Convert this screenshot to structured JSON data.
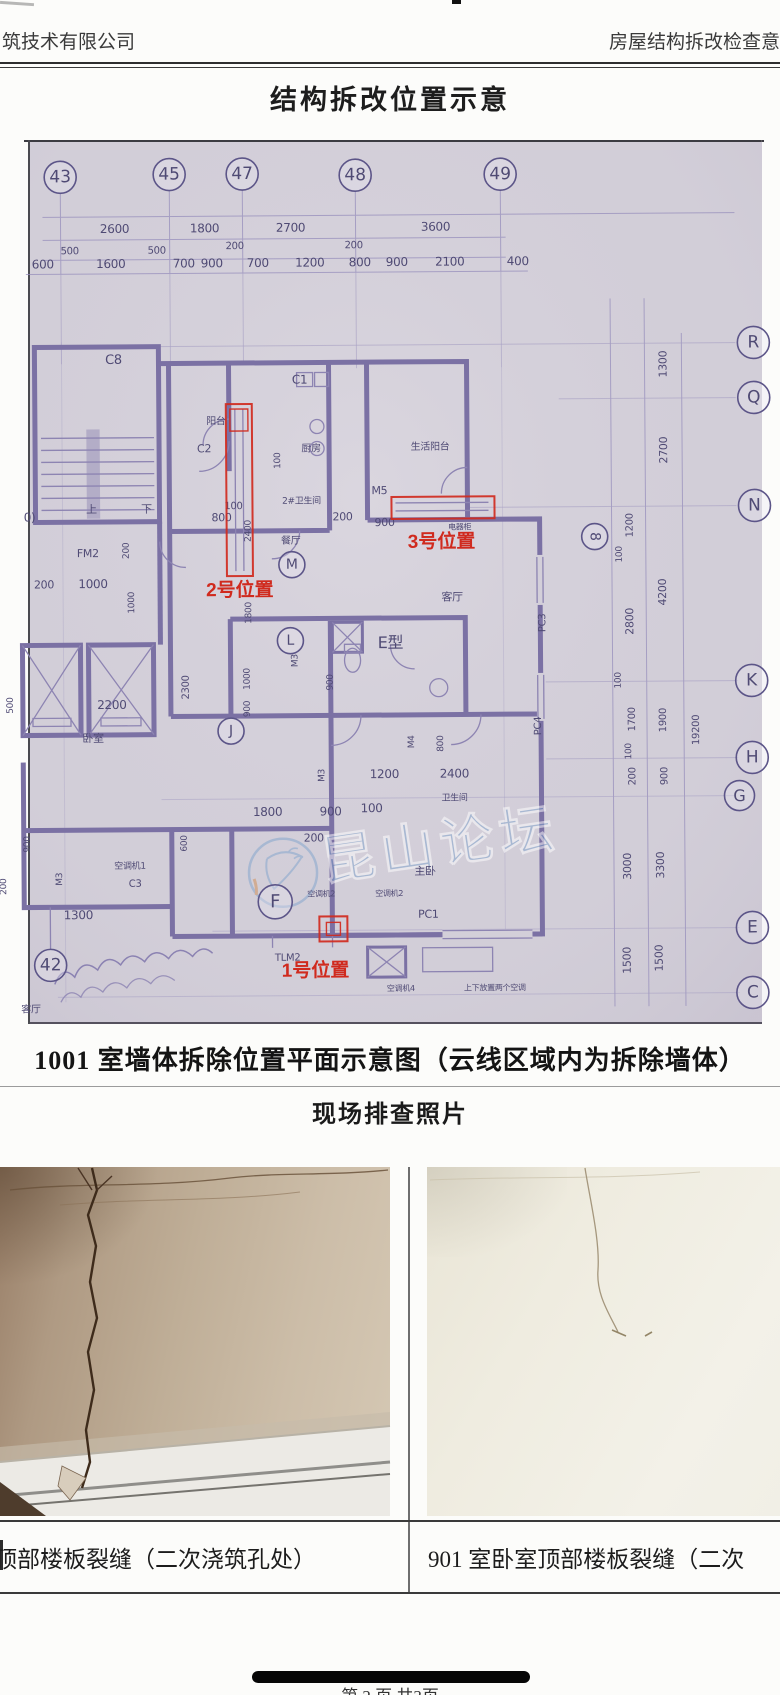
{
  "header": {
    "left": "筑技术有限公司",
    "right": "房屋结构拆改检查意"
  },
  "title": "结构拆改位置示意",
  "plan": {
    "caption": "1001 室墙体拆除位置平面示意图（云线区域内为拆除墙体）",
    "unit_type_label": "E型",
    "watermark": {
      "text": "昆山论坛",
      "color": "#7ea2cc"
    },
    "colors": {
      "red": "#d02a1e",
      "ink": "#4f4a74",
      "bubble": "#5c5588"
    },
    "bubbles": [
      {
        "x": 63,
        "y": 175,
        "t": "43",
        "r": 16
      },
      {
        "x": 172,
        "y": 173,
        "t": "45",
        "r": 16
      },
      {
        "x": 245,
        "y": 173,
        "t": "47",
        "r": 16
      },
      {
        "x": 358,
        "y": 175,
        "t": "48",
        "r": 16
      },
      {
        "x": 503,
        "y": 175,
        "t": "49",
        "r": 16
      },
      {
        "x": 755,
        "y": 345,
        "t": "R",
        "r": 16
      },
      {
        "x": 755,
        "y": 400,
        "t": "Q",
        "r": 16
      },
      {
        "x": 755,
        "y": 508,
        "t": "N",
        "r": 16
      },
      {
        "x": 751,
        "y": 683,
        "t": "K",
        "r": 16
      },
      {
        "x": 751,
        "y": 760,
        "t": "H",
        "r": 16
      },
      {
        "x": 738,
        "y": 798,
        "t": "G",
        "r": 15
      },
      {
        "x": 750,
        "y": 930,
        "t": "E",
        "r": 16
      },
      {
        "x": 750,
        "y": 995,
        "t": "C",
        "r": 16
      },
      {
        "x": 292,
        "y": 564,
        "t": "M",
        "r": 13
      },
      {
        "x": 290,
        "y": 640,
        "t": "L",
        "r": 13
      },
      {
        "x": 230,
        "y": 730,
        "t": "J",
        "r": 13
      },
      {
        "x": 273,
        "y": 901,
        "t": "F",
        "r": 17
      },
      {
        "x": 595,
        "y": 538,
        "t": "8",
        "r": 13,
        "rot": 90
      },
      {
        "x": 48,
        "y": 963,
        "t": "42",
        "r": 16
      }
    ],
    "labels": [
      {
        "x": 117,
        "y": 231,
        "t": "2600",
        "s": 12
      },
      {
        "x": 207,
        "y": 231,
        "t": "1800",
        "s": 12
      },
      {
        "x": 293,
        "y": 231,
        "t": "2700",
        "s": 12
      },
      {
        "x": 438,
        "y": 231,
        "t": "3600",
        "s": 12
      },
      {
        "x": 72,
        "y": 252,
        "t": "500",
        "s": 10
      },
      {
        "x": 159,
        "y": 252,
        "t": "500",
        "s": 10
      },
      {
        "x": 237,
        "y": 248,
        "t": "200",
        "s": 10
      },
      {
        "x": 356,
        "y": 248,
        "t": "200",
        "s": 10
      },
      {
        "x": 45,
        "y": 266,
        "t": "600",
        "s": 12
      },
      {
        "x": 113,
        "y": 266,
        "t": "1600",
        "s": 12
      },
      {
        "x": 186,
        "y": 266,
        "t": "700",
        "s": 12
      },
      {
        "x": 214,
        "y": 266,
        "t": "900",
        "s": 12
      },
      {
        "x": 260,
        "y": 266,
        "t": "700",
        "s": 12
      },
      {
        "x": 312,
        "y": 266,
        "t": "1200",
        "s": 12
      },
      {
        "x": 362,
        "y": 266,
        "t": "800",
        "s": 12
      },
      {
        "x": 399,
        "y": 266,
        "t": "900",
        "s": 12
      },
      {
        "x": 452,
        "y": 266,
        "t": "2100",
        "s": 12
      },
      {
        "x": 520,
        "y": 266,
        "t": "400",
        "s": 12
      },
      {
        "x": 668,
        "y": 366,
        "t": "1300",
        "rot": -90,
        "s": 11
      },
      {
        "x": 668,
        "y": 452,
        "t": "2700",
        "rot": -90,
        "s": 11
      },
      {
        "x": 633,
        "y": 527,
        "t": "1200",
        "rot": -90,
        "s": 10
      },
      {
        "x": 622,
        "y": 556,
        "t": "100",
        "rot": -90,
        "s": 9
      },
      {
        "x": 666,
        "y": 594,
        "t": "4200",
        "rot": -90,
        "s": 11
      },
      {
        "x": 633,
        "y": 623,
        "t": "2800",
        "rot": -90,
        "s": 11
      },
      {
        "x": 620,
        "y": 682,
        "t": "100",
        "rot": -90,
        "s": 9
      },
      {
        "x": 634,
        "y": 721,
        "t": "1700",
        "rot": -90,
        "s": 10
      },
      {
        "x": 665,
        "y": 722,
        "t": "1900",
        "rot": -90,
        "s": 10
      },
      {
        "x": 698,
        "y": 732,
        "t": "19200",
        "rot": -90,
        "s": 10
      },
      {
        "x": 630,
        "y": 753,
        "t": "100",
        "rot": -90,
        "s": 9
      },
      {
        "x": 634,
        "y": 778,
        "t": "200",
        "rot": -90,
        "s": 10
      },
      {
        "x": 666,
        "y": 778,
        "t": "900",
        "rot": -90,
        "s": 10
      },
      {
        "x": 629,
        "y": 868,
        "t": "3000",
        "rot": -90,
        "s": 11
      },
      {
        "x": 662,
        "y": 867,
        "t": "3300",
        "rot": -90,
        "s": 11
      },
      {
        "x": 628,
        "y": 962,
        "t": "1500",
        "rot": -90,
        "s": 11
      },
      {
        "x": 660,
        "y": 960,
        "t": "1500",
        "rot": -90,
        "s": 11
      },
      {
        "x": 115,
        "y": 362,
        "t": "C8",
        "s": 13
      },
      {
        "x": 92,
        "y": 511,
        "t": "上",
        "s": 11
      },
      {
        "x": 147,
        "y": 511,
        "t": "下",
        "s": 11
      },
      {
        "x": 88,
        "y": 555,
        "t": "FM2",
        "s": 11
      },
      {
        "x": 44,
        "y": 586,
        "t": "200",
        "s": 11
      },
      {
        "x": 93,
        "y": 586,
        "t": "1000",
        "s": 12
      },
      {
        "x": 129,
        "y": 549,
        "t": "200",
        "rot": -90,
        "s": 9
      },
      {
        "x": 134,
        "y": 601,
        "t": "1000",
        "rot": -90,
        "s": 9
      },
      {
        "x": 30,
        "y": 519,
        "t": "0)",
        "s": 12
      },
      {
        "x": 111,
        "y": 707,
        "t": "2200",
        "s": 12
      },
      {
        "x": 12,
        "y": 703,
        "t": "500",
        "rot": -90,
        "s": 9
      },
      {
        "x": 92,
        "y": 740,
        "t": "卧室",
        "s": 11
      },
      {
        "x": 188,
        "y": 686,
        "t": "2300",
        "rot": -90,
        "s": 10
      },
      {
        "x": 249,
        "y": 678,
        "t": "1000",
        "rot": -90,
        "s": 9
      },
      {
        "x": 249,
        "y": 708,
        "t": "900",
        "rot": -90,
        "s": 9
      },
      {
        "x": 28,
        "y": 842,
        "t": "900",
        "rot": -90,
        "s": 9
      },
      {
        "x": 4,
        "y": 884,
        "t": "200",
        "rot": -90,
        "s": 9
      },
      {
        "x": 60,
        "y": 877,
        "t": "M3",
        "rot": -90,
        "s": 9
      },
      {
        "x": 128,
        "y": 867,
        "t": "空调机1",
        "s": 9
      },
      {
        "x": 133,
        "y": 885,
        "t": "C3",
        "s": 10
      },
      {
        "x": 76,
        "y": 917,
        "t": "1300",
        "s": 12
      },
      {
        "x": 217,
        "y": 423,
        "t": "阳台",
        "s": 10
      },
      {
        "x": 205,
        "y": 451,
        "t": "C2",
        "s": 11
      },
      {
        "x": 301,
        "y": 383,
        "t": "C1",
        "s": 12
      },
      {
        "x": 312,
        "y": 451,
        "t": "厨房",
        "s": 10
      },
      {
        "x": 281,
        "y": 460,
        "t": "100",
        "rot": -90,
        "s": 9
      },
      {
        "x": 431,
        "y": 450,
        "t": "生活阳台",
        "s": 10
      },
      {
        "x": 380,
        "y": 494,
        "t": "M5",
        "s": 11
      },
      {
        "x": 302,
        "y": 503,
        "t": "2#卫生间",
        "s": 9
      },
      {
        "x": 234,
        "y": 508,
        "t": "100",
        "s": 10
      },
      {
        "x": 222,
        "y": 520,
        "t": "800",
        "s": 11
      },
      {
        "x": 343,
        "y": 520,
        "t": "200",
        "s": 11
      },
      {
        "x": 385,
        "y": 526,
        "t": "900",
        "s": 11
      },
      {
        "x": 460,
        "y": 530,
        "t": "电器柜",
        "s": 8
      },
      {
        "x": 291,
        "y": 543,
        "t": "餐厅",
        "s": 10
      },
      {
        "x": 251,
        "y": 530,
        "t": "2400",
        "rot": -90,
        "s": 9
      },
      {
        "x": 251,
        "y": 612,
        "t": "1800",
        "rot": -90,
        "s": 9
      },
      {
        "x": 452,
        "y": 601,
        "t": "客厅",
        "s": 11
      },
      {
        "x": 545,
        "y": 624,
        "t": "PC3",
        "rot": -90,
        "s": 10
      },
      {
        "x": 390,
        "y": 648,
        "t": "E型",
        "s": 16
      },
      {
        "x": 297,
        "y": 660,
        "t": "M3",
        "rot": -90,
        "s": 9
      },
      {
        "x": 332,
        "y": 682,
        "t": "900",
        "rot": -90,
        "s": 9
      },
      {
        "x": 323,
        "y": 775,
        "t": "M3",
        "rot": -90,
        "s": 9
      },
      {
        "x": 413,
        "y": 742,
        "t": "M4",
        "rot": -90,
        "s": 9
      },
      {
        "x": 442,
        "y": 744,
        "t": "800",
        "rot": -90,
        "s": 9
      },
      {
        "x": 185,
        "y": 842,
        "t": "600",
        "rot": -90,
        "s": 9
      },
      {
        "x": 383,
        "y": 778,
        "t": "1200",
        "s": 12
      },
      {
        "x": 453,
        "y": 778,
        "t": "2400",
        "s": 12
      },
      {
        "x": 453,
        "y": 801,
        "t": "卫生间",
        "s": 9
      },
      {
        "x": 266,
        "y": 815,
        "t": "1800",
        "s": 12
      },
      {
        "x": 329,
        "y": 815,
        "t": "900",
        "s": 12
      },
      {
        "x": 370,
        "y": 812,
        "t": "100",
        "s": 12
      },
      {
        "x": 312,
        "y": 841,
        "t": "200",
        "s": 11
      },
      {
        "x": 540,
        "y": 727,
        "t": "PC4",
        "rot": -90,
        "s": 10
      },
      {
        "x": 423,
        "y": 875,
        "t": "主卧",
        "s": 11
      },
      {
        "x": 426,
        "y": 918,
        "t": "PC1",
        "s": 11
      },
      {
        "x": 319,
        "y": 896,
        "t": "空调机2",
        "s": 8
      },
      {
        "x": 387,
        "y": 896,
        "t": "空调机2",
        "s": 8
      },
      {
        "x": 285,
        "y": 960,
        "t": "TLM2",
        "s": 10
      },
      {
        "x": 398,
        "y": 991,
        "t": "空调机4",
        "s": 8
      },
      {
        "x": 492,
        "y": 991,
        "t": "上下放置两个空调",
        "s": 8
      },
      {
        "x": 28,
        "y": 1010,
        "t": "客厅",
        "s": 10
      }
    ],
    "red_annotations": {
      "boxes": [
        {
          "x": 317,
          "y": 916,
          "w": 28,
          "h": 25
        },
        {
          "x": 324,
          "y": 922,
          "w": 14,
          "h": 13
        },
        {
          "x": 227,
          "y": 403,
          "w": 26,
          "h": 172
        },
        {
          "x": 231,
          "y": 408,
          "w": 18,
          "h": 22
        },
        {
          "x": 392,
          "y": 497,
          "w": 103,
          "h": 22
        }
      ],
      "labels": [
        {
          "x": 279,
          "y": 976,
          "t": "1号位置"
        },
        {
          "x": 206,
          "y": 595,
          "t": "2号位置"
        },
        {
          "x": 408,
          "y": 548,
          "t": "3号位置"
        }
      ]
    }
  },
  "photos": {
    "heading": "现场排查照片",
    "left_caption": "顶部楼板裂缝（二次浇筑孔处）",
    "right_caption": "901 室卧室顶部楼板裂缝（二次"
  },
  "footer": {
    "page_text": "第 2 页 共3页"
  }
}
